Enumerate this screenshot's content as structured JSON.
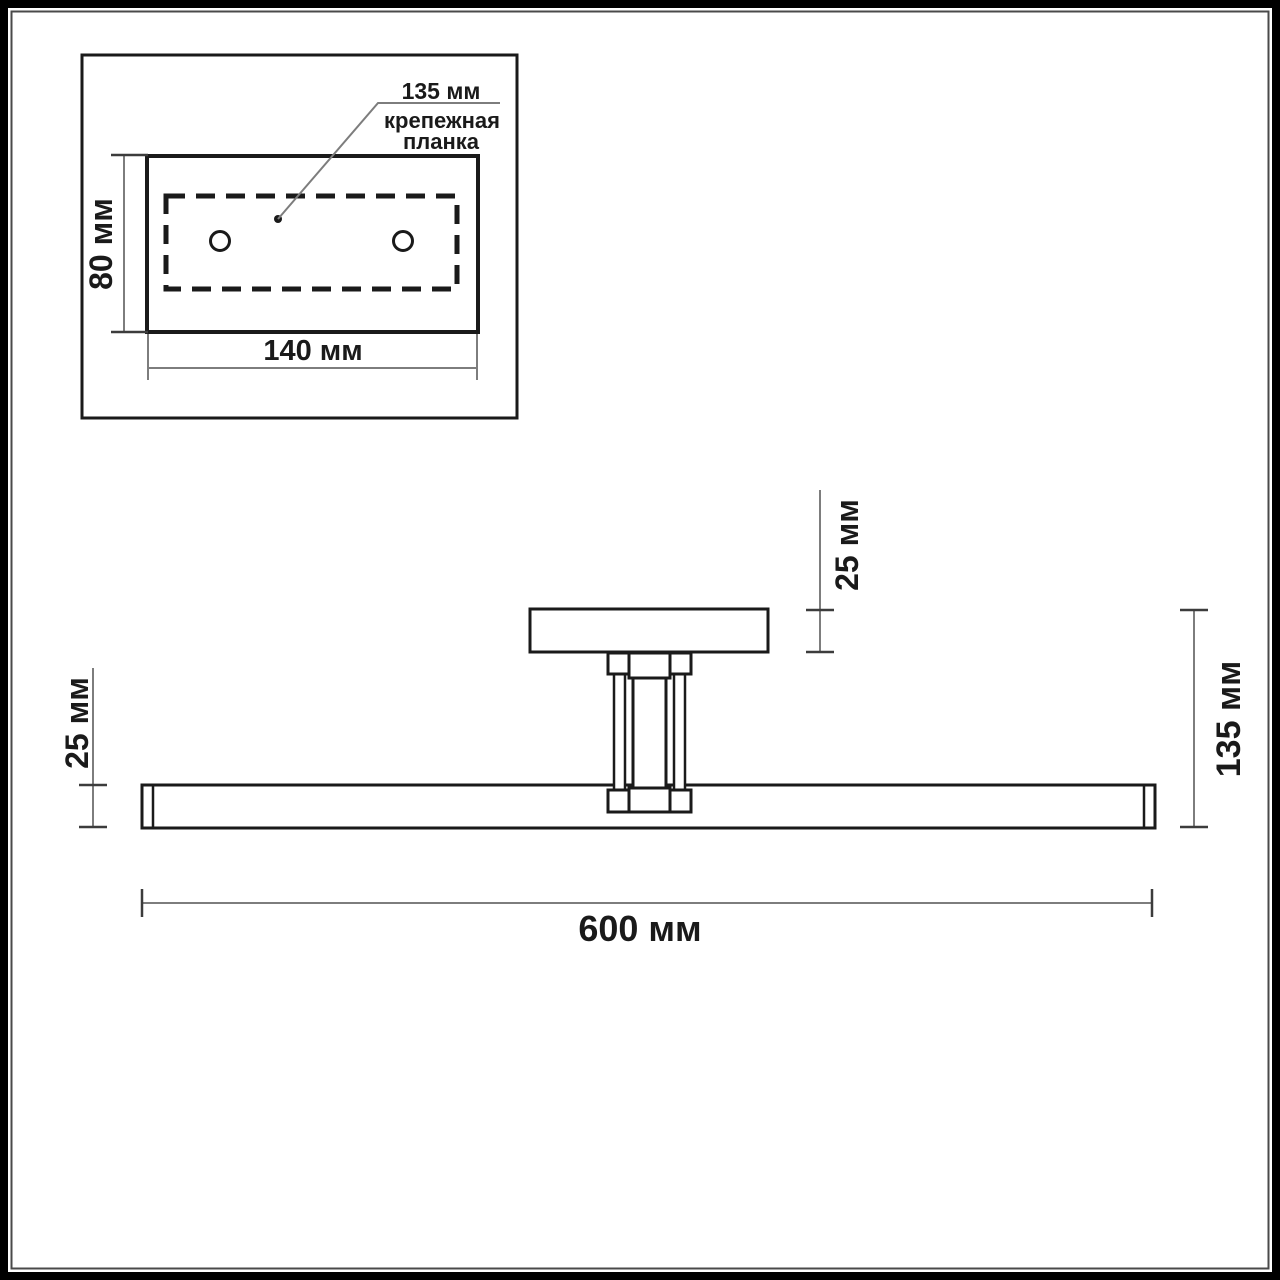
{
  "drawing": {
    "kind": "luminaire-dimension-drawing",
    "units": "мм"
  },
  "inset": {
    "callout_dim": "135 мм",
    "callout_label_line1": "крепежная",
    "callout_label_line2": "планка",
    "height_dim": "80 мм",
    "width_dim": "140 мм"
  },
  "side_view": {
    "plate_height_dim": "25 мм",
    "bar_height_dim": "25 мм",
    "total_height_dim": "135 мм",
    "length_dim": "600 мм"
  },
  "colors": {
    "outline": "#1a1a1a",
    "dim_line": "#7d7d7d",
    "tick": "#3c3c3c",
    "frame": "#000000",
    "frame_inner": "#4a4a4a",
    "background": "#ffffff"
  }
}
